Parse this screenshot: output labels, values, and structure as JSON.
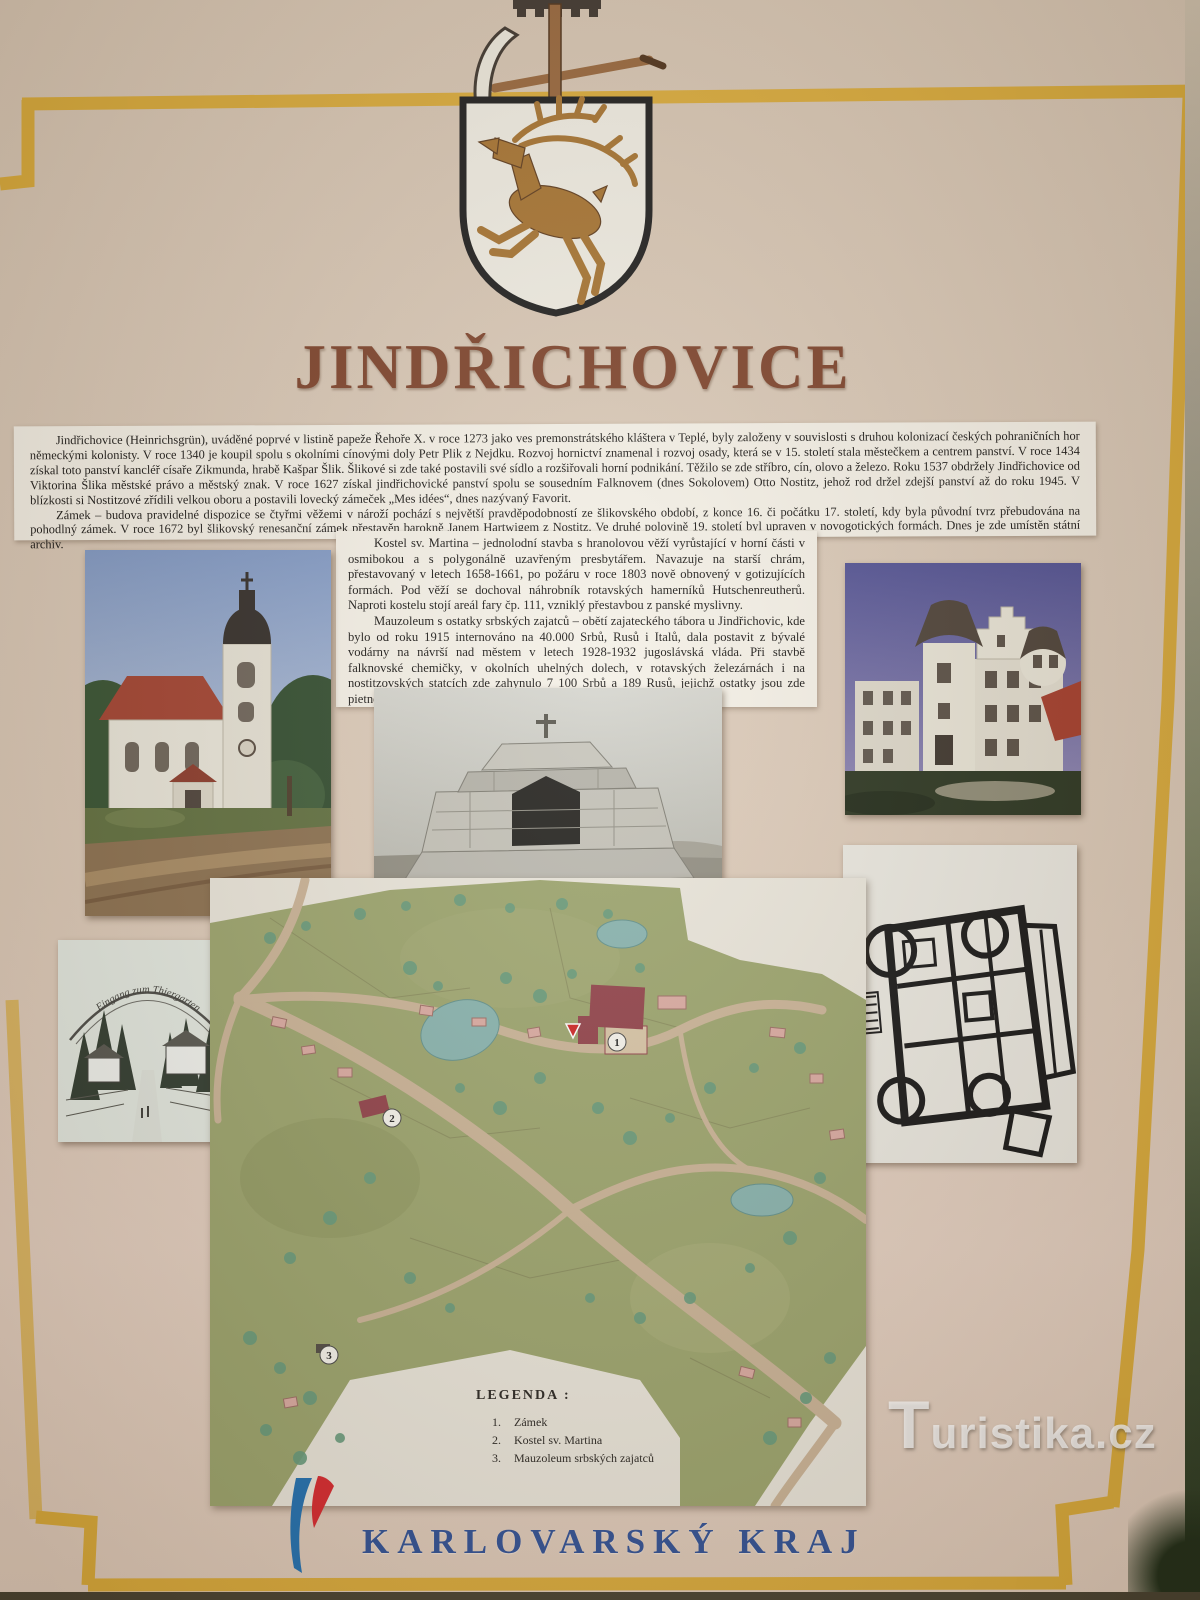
{
  "panel": {
    "title": "JINDŘICHOVICE",
    "intro": {
      "paragraph1": "Jindřichovice (Heinrichsgrün), uváděné poprvé v listině papeže Řehoře X. v roce 1273 jako ves premonstrátského kláštera v Teplé, byly založeny v souvislosti s druhou kolonizací českých pohraničních hor německými kolonisty.  V roce 1340 je koupil spolu s okolními cínovými doly Petr Plik z Nejdku.  Rozvoj hornictví znamenal i rozvoj osady,  která se v 15. století stala městečkem a centrem panství.  V roce 1434 získal toto panství kancléř císaře Zikmunda,  hrabě Kašpar Šlik. Šlikové si zde také postavili své sídlo a rozšiřovali horní podnikání.  Těžilo se zde stříbro, cín, olovo a železo. Roku 1537 obdržely Jindřichovice od Viktorina Šlika městské právo a městský znak.  V roce 1627 získal  jindřichovické panství spolu se sousedním Falknovem  (dnes Sokolovem) Otto Nostitz, jehož rod držel zdejší panství  až do roku 1945.  V blízkosti si Nostitzové zřídili velkou oboru a postavili lovecký zámeček „Mes idées“, dnes nazývaný Favorit.",
      "paragraph2": "Zámek – budova pravidelné dispozice  se čtyřmi věžemi v nároží pochází  s největší pravděpodobností ze šlikovského období, z konce 16. či počátku 17. století,  kdy byla původní tvrz přebudována na pohodlný zámek. V roce 1672 byl šlikovský renesanční zámek přestavěn  barokně Janem Hartwigem z Nostitz. Ve druhé polovině 19. století byl upraven v novogotických formách. Dnes je zde umístěn státní archiv."
    },
    "column": {
      "kostel_paragraph": "Kostel sv. Martina – jednolodní stavba s hranolovou věží vyrůstající v horní části v osmibokou  a  s polygonálně uzavřeným presbytářem.  Navazuje  na  starší  chrám, přestavovaný v letech 1658-1661, po požáru v roce 1803 nově obnovený v gotizujících formách.  Pod věží se dochoval  náhrobník rotavských hamerníků  Hutschenreutherů. Naproti kostelu stojí areál fary čp. 111, vzniklý přestavbou  z panské myslivny.",
      "mauzoleum_paragraph": "Mauzoleum s ostatky srbských zajatců – obětí zajateckého tábora u Jindřichovic, kde bylo od roku 1915 internováno na 40.000 Srbů, Rusů i Italů, dala postavit z bývalé vodárny  na návrší nad městem  v letech  1928-1932  jugoslávská vláda.  Při stavbě falknovské chemičky,  v okolních uhelných dolech,  v  rotavských železárnách  i na nostitzovských statcích zde zahynulo 7 100 Srbů  a 189 Rusů,  jejichž ostatky jsou zde pietně uloženy."
    },
    "postcard": {
      "caption": "Eingang zum Thiergarten"
    },
    "map": {
      "legend": {
        "title": "LEGENDA :",
        "items": [
          {
            "num": "1.",
            "label": "Zámek"
          },
          {
            "num": "2.",
            "label": "Kostel sv. Martina"
          },
          {
            "num": "3.",
            "label": "Mauzoleum srbských zajatců"
          }
        ]
      },
      "markers": {
        "zamek": "1",
        "kostel": "2",
        "mauzoleum": "3"
      }
    },
    "footer": {
      "region_name": "KARLOVARSKÝ KRAJ"
    },
    "watermark": {
      "text": "Turistika.cz"
    }
  },
  "colors": {
    "panel_beige": "#d9c8b6",
    "frame_yellow": "#d9a933",
    "title_brown": "#7c4129",
    "paper_white": "#f4f0e6",
    "region_blue": "#2e4f94",
    "logo_blue": "#1f6fb0",
    "logo_red": "#d6262c",
    "map_green": "#9aa36b",
    "map_road_tan": "#c9b295",
    "map_water_teal": "#86b2ad",
    "map_landmark_red": "#8f3f47",
    "stag_brown": "#a5722f"
  }
}
